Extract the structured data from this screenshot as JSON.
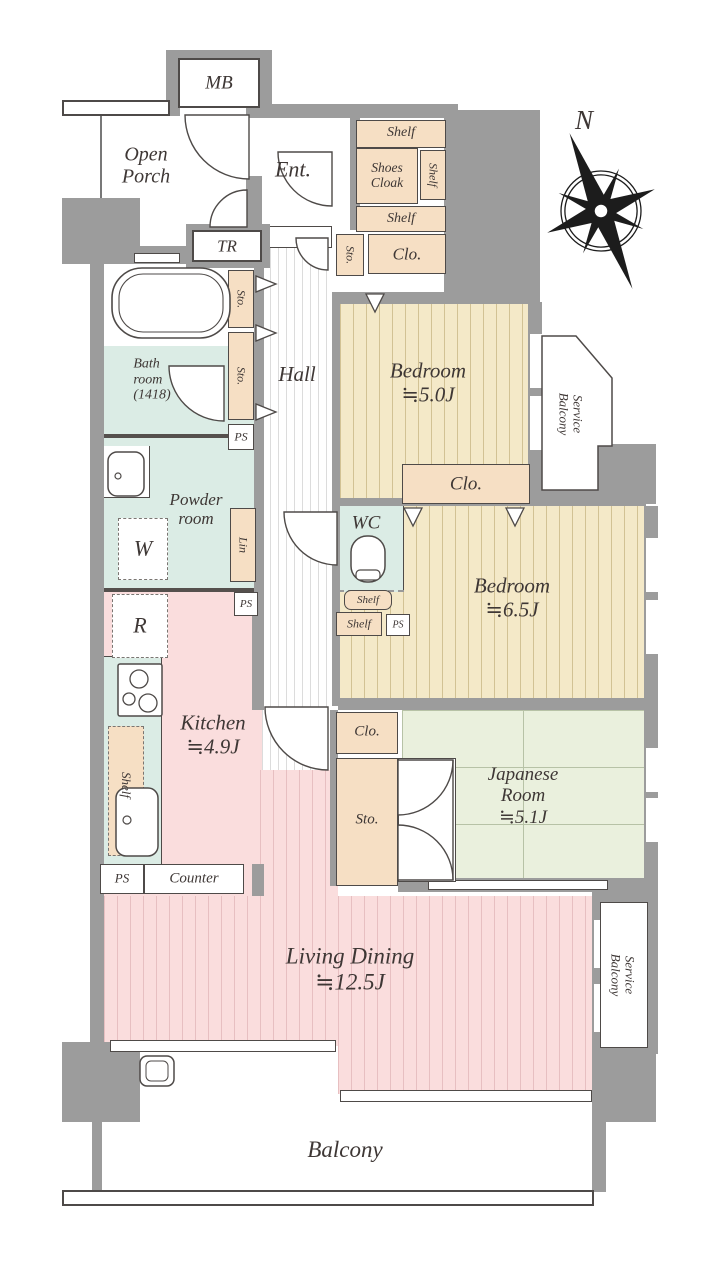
{
  "labels": {
    "mb": "MB",
    "tr": "TR",
    "open_porch": "Open\nPorch",
    "ent": "Ent.",
    "shelf": "Shelf",
    "shoes_cloak": "Shoes\nCloak",
    "sto": "Sto.",
    "clo": "Clo.",
    "ps": "PS",
    "lin": "Lin",
    "hall": "Hall",
    "wc": "WC",
    "w": "W",
    "r": "R",
    "bath": "Bath\nroom\n(1418)",
    "powder": "Powder\nroom",
    "bedroom1": "Bedroom\n≒5.0J",
    "bedroom2": "Bedroom\n≒6.5J",
    "kitchen": "Kitchen\n≒4.9J",
    "japanese": "Japanese\nRoom\n≒5.1J",
    "living": "Living Dining\n≒12.5J",
    "service_balcony": "Service\nBalcony",
    "balcony": "Balcony",
    "counter": "Counter",
    "north": "N"
  },
  "colors": {
    "wall_gray": "#9c9c9c",
    "outline": "#4e4a48",
    "storage_beige": "#f6dfc4",
    "bedroom_tan": "#f4e9c8",
    "living_pink": "#fadddd",
    "wet_area_mint": "#dbece5",
    "tatami_green": "#eaf0dd"
  },
  "fixtures": [
    "bathtub",
    "toilet",
    "stove",
    "kitchen-sink",
    "wash-basin",
    "slop-sink",
    "compass-rose",
    "door-swings",
    "folding-door-markers",
    "windows"
  ]
}
